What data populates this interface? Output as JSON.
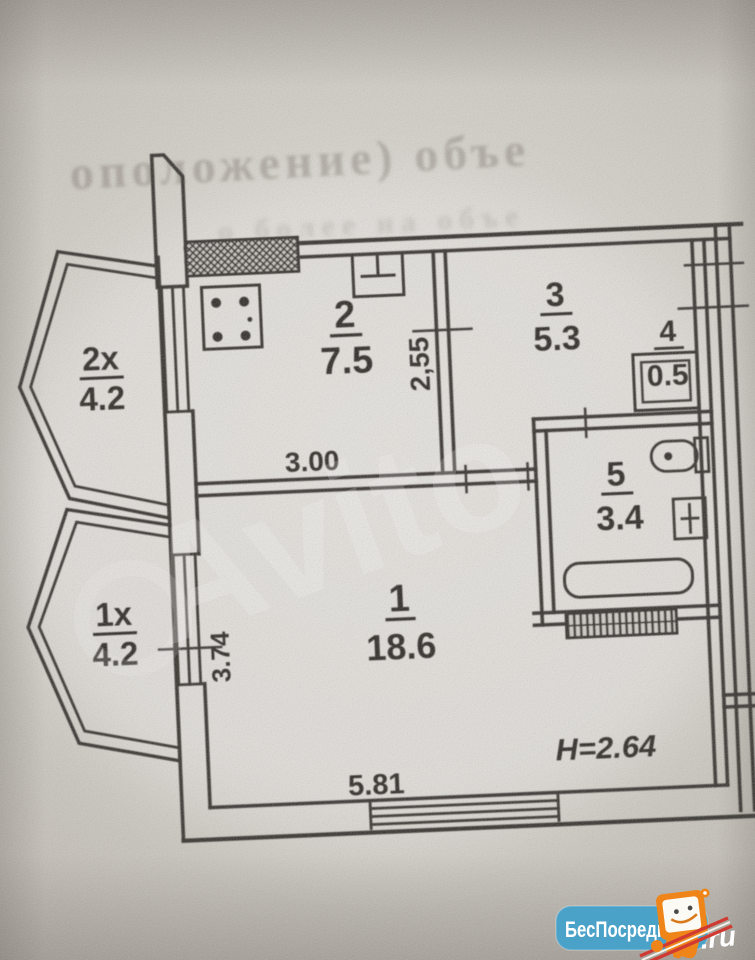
{
  "watermark": "Avito",
  "bleed": {
    "line1": "оположение) объе",
    "line2": "о более на объе"
  },
  "rooms": [
    {
      "number": "2х",
      "area": "4.2"
    },
    {
      "number": "1х",
      "area": "4.2"
    },
    {
      "number": "2",
      "area": "7.5"
    },
    {
      "number": "3",
      "area": "5.3"
    },
    {
      "number": "4",
      "area": "0.5"
    },
    {
      "number": "5",
      "area": "3.4"
    },
    {
      "number": "1",
      "area": "18.6"
    }
  ],
  "dimensions": {
    "kitchen_width": "3.00",
    "kitchen_depth": "2,55",
    "room_depth": "3.74",
    "room_width": "5.81",
    "ceiling_height": "H=2.64"
  },
  "logo": {
    "name": "БесПосредника",
    "tld": ".ru",
    "badge_color": "#4ba2c9",
    "mascot_color": "#ef8418"
  }
}
